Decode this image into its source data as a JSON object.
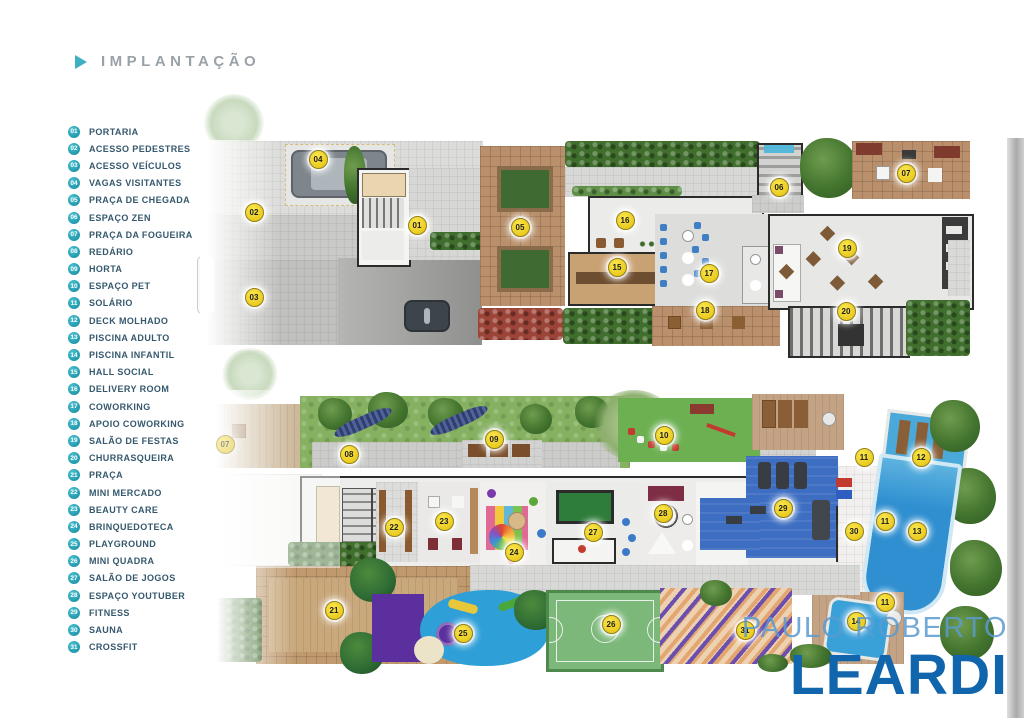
{
  "title": {
    "text": "IMPLANTAÇÃO"
  },
  "legend": {
    "items": [
      {
        "num": "01",
        "label": "PORTARIA"
      },
      {
        "num": "02",
        "label": "ACESSO PEDESTRES"
      },
      {
        "num": "03",
        "label": "ACESSO VEÍCULOS"
      },
      {
        "num": "04",
        "label": "VAGAS VISITANTES"
      },
      {
        "num": "05",
        "label": "PRAÇA DE CHEGADA"
      },
      {
        "num": "06",
        "label": "ESPAÇO ZEN"
      },
      {
        "num": "07",
        "label": "PRAÇA DA FOGUEIRA"
      },
      {
        "num": "08",
        "label": "REDÁRIO"
      },
      {
        "num": "09",
        "label": "HORTA"
      },
      {
        "num": "10",
        "label": "ESPAÇO PET"
      },
      {
        "num": "11",
        "label": "SOLÁRIO"
      },
      {
        "num": "12",
        "label": "DECK MOLHADO"
      },
      {
        "num": "13",
        "label": "PISCINA ADULTO"
      },
      {
        "num": "14",
        "label": "PISCINA INFANTIL"
      },
      {
        "num": "15",
        "label": "HALL SOCIAL"
      },
      {
        "num": "16",
        "label": "DELIVERY ROOM"
      },
      {
        "num": "17",
        "label": "COWORKING"
      },
      {
        "num": "18",
        "label": "APOIO COWORKING"
      },
      {
        "num": "19",
        "label": "SALÃO DE FESTAS"
      },
      {
        "num": "20",
        "label": "CHURRASQUEIRA"
      },
      {
        "num": "21",
        "label": "PRAÇA"
      },
      {
        "num": "22",
        "label": "MINI MERCADO"
      },
      {
        "num": "23",
        "label": "BEAUTY CARE"
      },
      {
        "num": "24",
        "label": "BRINQUEDOTECA"
      },
      {
        "num": "25",
        "label": "PLAYGROUND"
      },
      {
        "num": "26",
        "label": "MINI QUADRA"
      },
      {
        "num": "27",
        "label": "SALÃO DE JOGOS"
      },
      {
        "num": "28",
        "label": "ESPAÇO YOUTUBER"
      },
      {
        "num": "29",
        "label": "FITNESS"
      },
      {
        "num": "30",
        "label": "SAUNA"
      },
      {
        "num": "31",
        "label": "CROSSFIT"
      }
    ]
  },
  "plans": {
    "top": {
      "name": "site-plan-upper",
      "markers": [
        {
          "num": "01",
          "x": 416,
          "y": 224
        },
        {
          "num": "02",
          "x": 253,
          "y": 211
        },
        {
          "num": "03",
          "x": 253,
          "y": 296
        },
        {
          "num": "04",
          "x": 317,
          "y": 158
        },
        {
          "num": "05",
          "x": 519,
          "y": 226
        },
        {
          "num": "06",
          "x": 778,
          "y": 186
        },
        {
          "num": "07",
          "x": 905,
          "y": 172
        },
        {
          "num": "15",
          "x": 616,
          "y": 266
        },
        {
          "num": "16",
          "x": 624,
          "y": 219
        },
        {
          "num": "17",
          "x": 708,
          "y": 272
        },
        {
          "num": "18",
          "x": 704,
          "y": 309
        },
        {
          "num": "19",
          "x": 846,
          "y": 247
        },
        {
          "num": "20",
          "x": 845,
          "y": 310
        }
      ]
    },
    "bottom": {
      "name": "site-plan-lower",
      "markers": [
        {
          "num": "07",
          "x": 224,
          "y": 443,
          "faded": true
        },
        {
          "num": "08",
          "x": 348,
          "y": 453
        },
        {
          "num": "09",
          "x": 493,
          "y": 438
        },
        {
          "num": "10",
          "x": 663,
          "y": 434
        },
        {
          "num": "11",
          "x": 863,
          "y": 456
        },
        {
          "num": "12",
          "x": 920,
          "y": 456
        },
        {
          "num": "29",
          "x": 782,
          "y": 507
        },
        {
          "num": "22",
          "x": 393,
          "y": 526
        },
        {
          "num": "23",
          "x": 443,
          "y": 520
        },
        {
          "num": "11",
          "x": 884,
          "y": 520
        },
        {
          "num": "13",
          "x": 916,
          "y": 530
        },
        {
          "num": "30",
          "x": 853,
          "y": 530
        },
        {
          "num": "27",
          "x": 592,
          "y": 531
        },
        {
          "num": "28",
          "x": 662,
          "y": 512
        },
        {
          "num": "24",
          "x": 513,
          "y": 551
        },
        {
          "num": "21",
          "x": 333,
          "y": 609
        },
        {
          "num": "25",
          "x": 462,
          "y": 632
        },
        {
          "num": "26",
          "x": 610,
          "y": 623
        },
        {
          "num": "31",
          "x": 744,
          "y": 629
        },
        {
          "num": "11",
          "x": 884,
          "y": 601
        },
        {
          "num": "14",
          "x": 855,
          "y": 620
        }
      ]
    }
  },
  "watermark": {
    "line1": "PAULO ROBERTO",
    "line2": "LEARDI"
  },
  "colors": {
    "accent_teal": "#2aa6b9",
    "marker_yellow": "#eecf25",
    "watermark_light": "#5b9bd0",
    "watermark_dark": "#1065ad",
    "legend_text": "#35586d"
  }
}
